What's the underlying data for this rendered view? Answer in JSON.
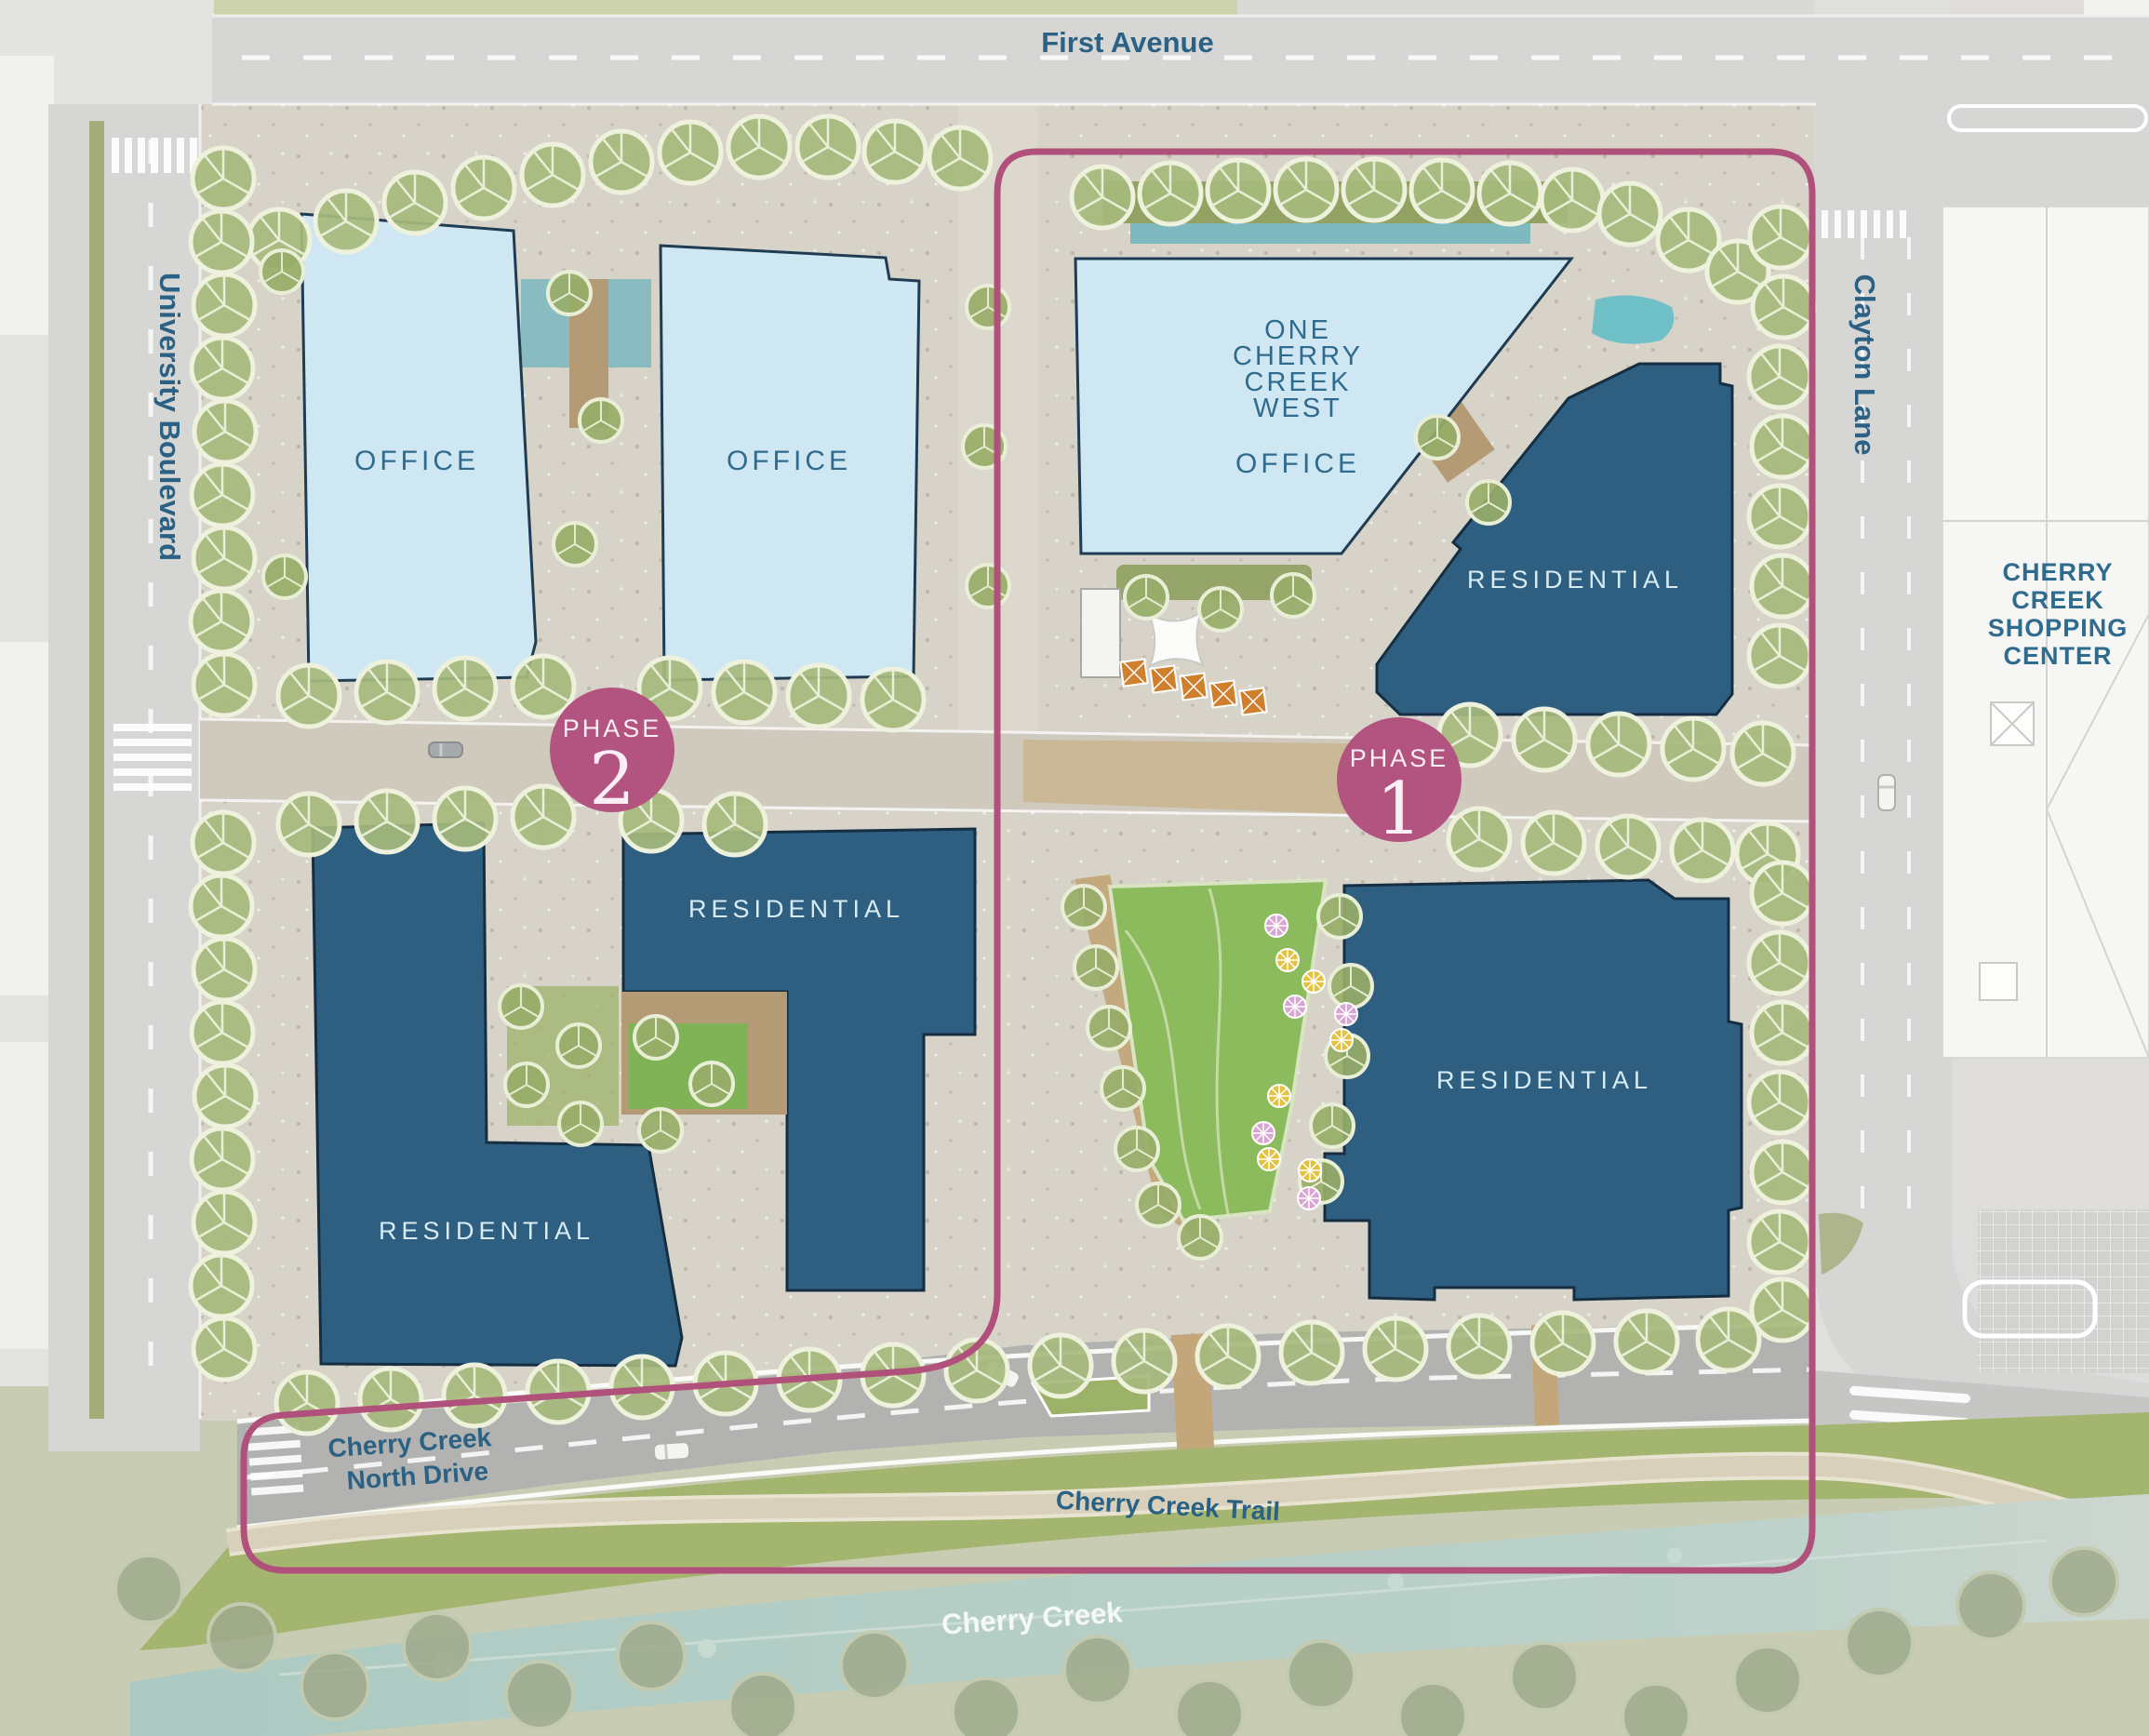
{
  "map": {
    "title": "Cherry Creek West master site plan",
    "streets": {
      "first_avenue": "First Avenue",
      "university_boulevard": "University Boulevard",
      "clayton_lane": "Clayton Lane",
      "north_drive_line1": "Cherry Creek",
      "north_drive_line2": "North Drive",
      "trail": "Cherry Creek Trail",
      "creek": "Cherry Creek"
    },
    "phases": {
      "p1": {
        "word": "PHASE",
        "num": "1"
      },
      "p2": {
        "word": "PHASE",
        "num": "2"
      }
    },
    "buildings": {
      "office_nw": "OFFICE",
      "office_n": "OFFICE",
      "occw_lines": [
        "ONE",
        "CHERRY",
        "CREEK",
        "WEST"
      ],
      "occw_use": "OFFICE",
      "residential_ne": "RESIDENTIAL",
      "residential_center": "RESIDENTIAL",
      "residential_sw": "RESIDENTIAL",
      "residential_se": "RESIDENTIAL"
    },
    "landmarks": {
      "shopping_center": [
        "CHERRY",
        "CREEK",
        "SHOPPING",
        "CENTER"
      ]
    },
    "colors": {
      "phase_accent": "#b3537f",
      "office_fill": "#cfe7f2",
      "residential_fill": "#2e5f80",
      "street_label": "#2a6184",
      "building_label_light": "#d8ecf5",
      "water": "#accac2",
      "lawn": "#7fb356",
      "tree": "#a6ba7c",
      "road": "#d6d6d5",
      "pavement": "#d8d3c9"
    }
  }
}
